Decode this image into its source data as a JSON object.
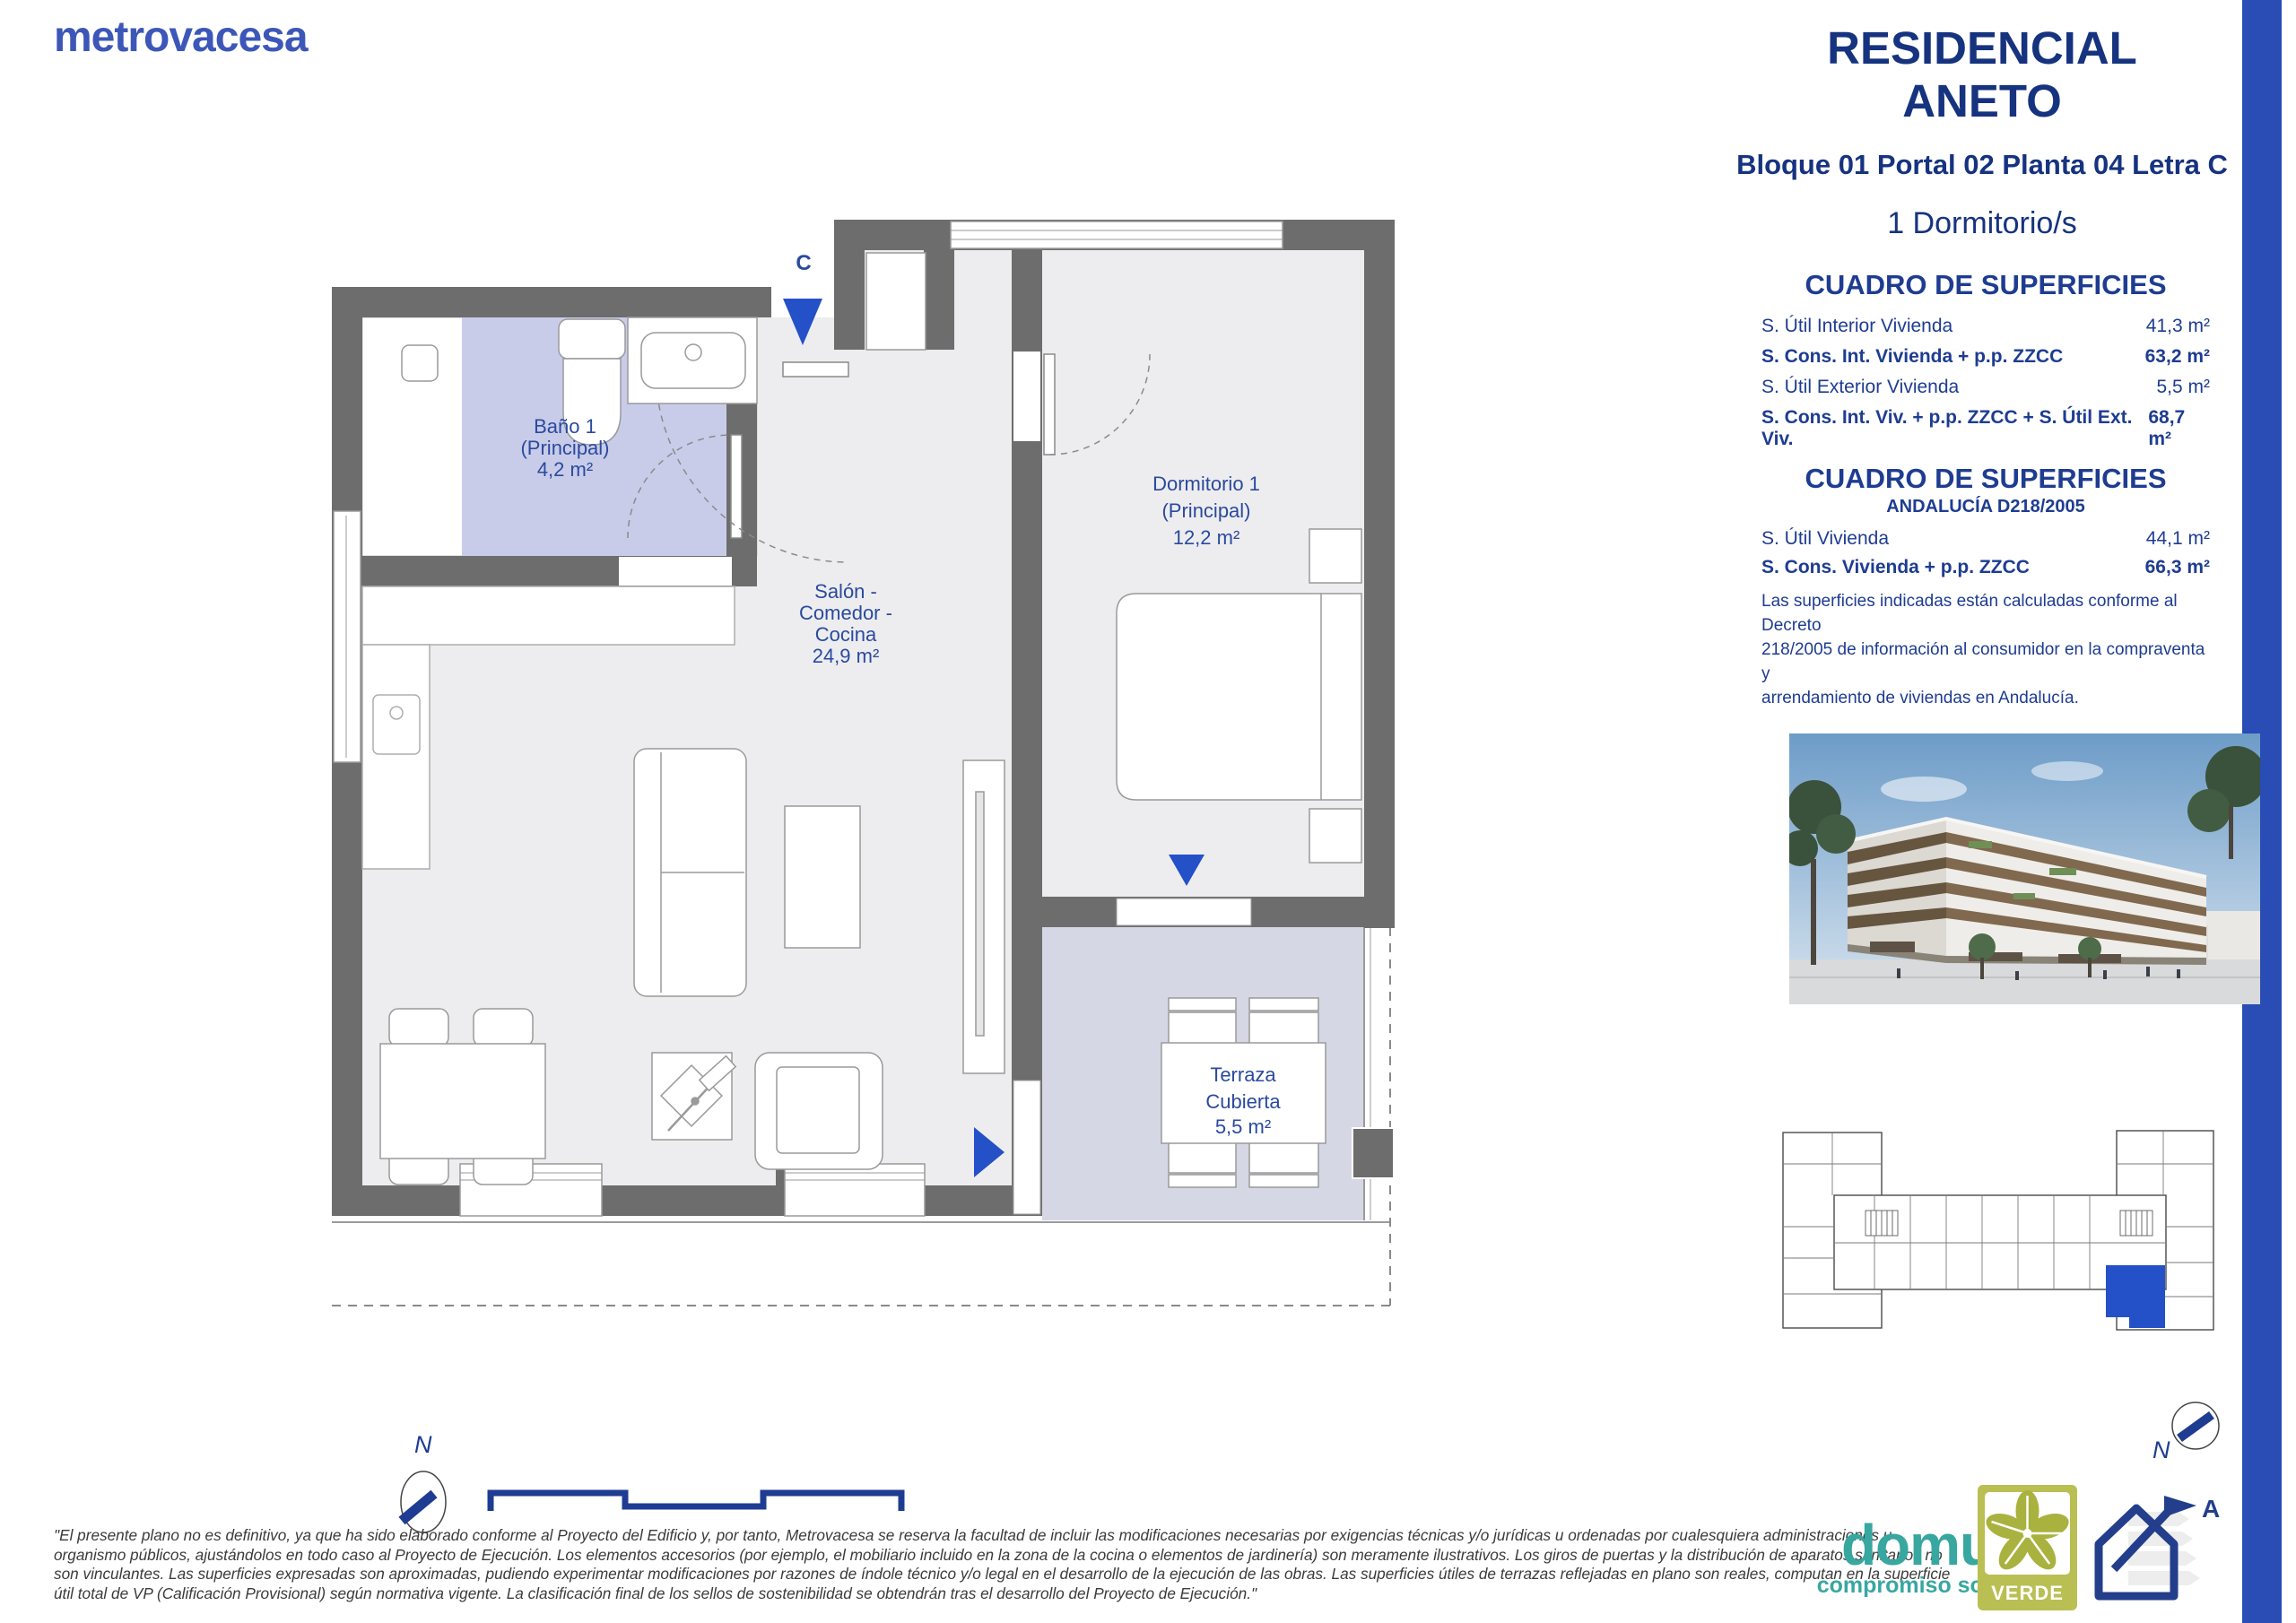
{
  "brand": {
    "logo_text": "metrovacesa"
  },
  "header": {
    "title_line1": "RESIDENCIAL",
    "title_line2": "ANETO",
    "location": "Bloque 01 Portal 02 Planta 04 Letra C",
    "bedrooms": "1 Dormitorio/s"
  },
  "surfaces": {
    "title": "CUADRO DE SUPERFICIES",
    "rows": [
      {
        "label": "S. Útil Interior Vivienda",
        "value": "41,3 m²"
      },
      {
        "label": "S. Cons. Int. Vivienda + p.p. ZZCC",
        "value": "63,2 m²"
      },
      {
        "label": "S. Útil Exterior Vivienda",
        "value": "5,5 m²"
      },
      {
        "label": "S. Cons. Int. Viv. + p.p. ZZCC + S. Útil Ext. Viv.",
        "value": "68,7 m²"
      }
    ]
  },
  "surfaces_andalucia": {
    "title": "CUADRO DE SUPERFICIES",
    "subtitle": "ANDALUCÍA D218/2005",
    "rows": [
      {
        "label": "S. Útil Vivienda",
        "value": "44,1 m²"
      },
      {
        "label": "S. Cons. Vivienda + p.p. ZZCC",
        "value": "66,3 m²"
      }
    ],
    "note_line1": "Las superficies indicadas están calculadas conforme al Decreto",
    "note_line2": "218/2005 de información al consumidor en la compraventa y",
    "note_line3": "arrendamiento de viviendas en Andalucía."
  },
  "floorplan": {
    "entrance_label": "C",
    "north_label": "N",
    "rooms": {
      "bath": {
        "line1": "Baño 1",
        "line2": "(Principal)",
        "area": "4,2 m²"
      },
      "living": {
        "line1": "Salón -",
        "line2": "Comedor -",
        "line3": "Cocina",
        "area": "24,9 m²"
      },
      "bedroom": {
        "line1": "Dormitorio 1",
        "line2": "(Principal)",
        "area": "12,2 m²"
      },
      "terrace": {
        "line1": "Terraza",
        "line2": "Cubierta",
        "area": "5,5 m²"
      }
    }
  },
  "keyplan": {
    "north_label": "N"
  },
  "footer": {
    "disclaimer_line1": "\"El presente plano no es definitivo, ya que ha sido elaborado conforme al Proyecto del Edificio y, por tanto, Metrovacesa se reserva la facultad de incluir las modificaciones necesarias por exigencias técnicas y/o jurídicas u ordenadas por cualesquiera administraciones u",
    "disclaimer_line2": "organismo públicos, ajustándolos en todo caso al Proyecto de Ejecución. Los elementos accesorios (por ejemplo, el mobiliario incluido en la zona de la cocina o elementos de jardinería) son meramente ilustrativos. Los giros de puertas y la distribución de aparatos sanitarios no",
    "disclaimer_line3": "son vinculantes. Las superficies expresadas son aproximadas, pudiendo experimentar modificaciones por razones de índole técnico y/o legal en el desarrollo de la ejecución de las obras. Las superficies útiles de terrazas reflejadas en plano son reales, computan en la superficie",
    "disclaimer_line4": "útil total de VP (Calificación Provisional) según normativa vigente. La clasificación final de los sellos de sostenibilidad se obtendrán tras el desarrollo del Proyecto de Ejecución.\"",
    "domum_part1": "domu",
    "domum_part2": "m",
    "domum_tagline": "compromiso sostenible",
    "verde_label": "VERDE",
    "energy_label": "A"
  },
  "colors": {
    "accent_blue": "#2a4cb5",
    "navy": "#1e3c91",
    "teal": "#38a7a0",
    "verde_olive": "#b9bf52",
    "wall_gray": "#6d6d6d",
    "bath_floor": "#c9cce9",
    "terrace_floor": "#d5d7e4"
  }
}
